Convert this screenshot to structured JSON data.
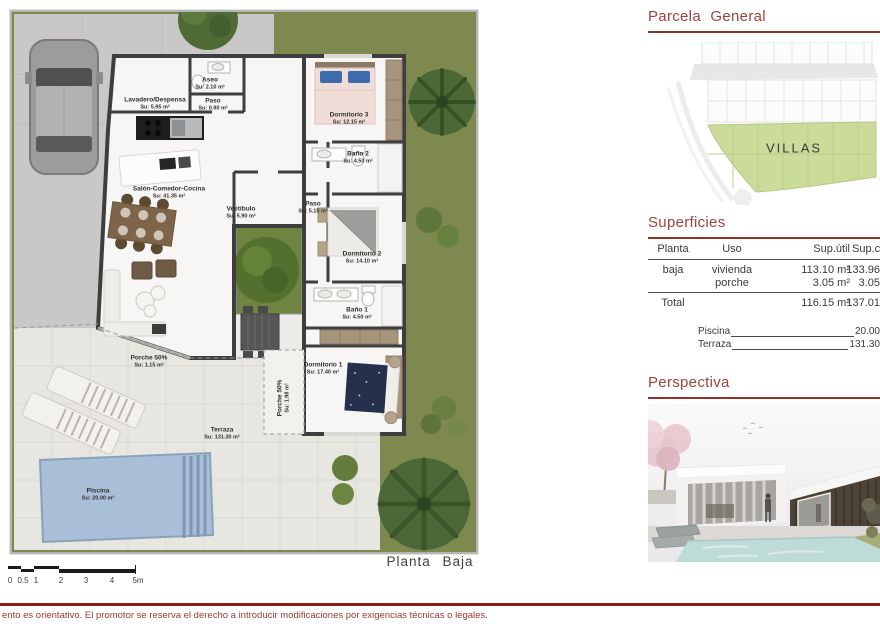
{
  "plan": {
    "caption": "Planta  Baja",
    "rooms": [
      {
        "name": "Lavadero/Despensa",
        "area": "Su: 5.95 m²"
      },
      {
        "name": "Aseo",
        "area": "Su: 2.10 m²"
      },
      {
        "name": "Paso",
        "area": "Su: 0.90 m²"
      },
      {
        "name": "Salón-Comedor-Cocina",
        "area": "Su: 41.35 m²"
      },
      {
        "name": "Vestíbulo",
        "area": "Su: 5.90 m²"
      },
      {
        "name": "Dormitorio 3",
        "area": "Su: 12.15 m²"
      },
      {
        "name": "Baño 2",
        "area": "Su: 4.50 m²"
      },
      {
        "name": "Paso",
        "area": "Su: 5.15 m²"
      },
      {
        "name": "Dormitorio 2",
        "area": "Su: 14.10 m²"
      },
      {
        "name": "Baño 1",
        "area": "Su: 4.50 m²"
      },
      {
        "name": "Dormitorio 1",
        "area": "Su: 17.40 m²"
      },
      {
        "name": "Porche 50%",
        "area": "Su: 1.98 m²"
      },
      {
        "name": "Porche 50%",
        "area": "Su: 1.15 m²"
      },
      {
        "name": "Terraza",
        "area": "Su: 131.30 m²"
      },
      {
        "name": "Piscina",
        "area": "Su: 20.00 m²"
      }
    ],
    "scale": {
      "labels": [
        "0",
        "0.5",
        "1",
        "2",
        "3",
        "4",
        "5m"
      ]
    }
  },
  "panel": {
    "parcela": {
      "title": "Parcela  General",
      "zone": "VILLAS"
    },
    "superficies": {
      "title": "Superficies",
      "col_planta": "Planta",
      "col_uso": "Uso",
      "col_util": "Sup.útil",
      "col_cons": "Sup.con",
      "rows": [
        {
          "planta": "baja",
          "uso": "vivienda",
          "util": "113.10 m²",
          "cons": "133.96"
        },
        {
          "planta": "",
          "uso": "porche",
          "util": "3.05 m²",
          "cons": "3.05"
        }
      ],
      "total_label": "Total",
      "total_util": "116.15 m²",
      "total_cons": "137.01",
      "extras": [
        {
          "label": "Piscina",
          "value": "20.00"
        },
        {
          "label": "Terraza",
          "value": "131.30"
        }
      ]
    },
    "perspectiva": {
      "title": "Perspectiva"
    }
  },
  "footer": {
    "disclaimer": "ento es orientativo. El promotor se reserva el derecho a introducir modificaciones por exigencias técnicas o legales."
  },
  "colors": {
    "accent_red": "#a0423a",
    "underline_red": "#8e3429",
    "footer_red": "#8e1d12",
    "lawn_green": "#7d894f",
    "courtyard_green": "#6e8440",
    "villas_green": "#cbdb9a",
    "pool_blue": "#a9bfd8",
    "wall_dark": "#3e3e3e",
    "terrace_tile": "#e8e6e1",
    "concrete": "#c9c8c6",
    "closet_tan": "#a6947c"
  }
}
